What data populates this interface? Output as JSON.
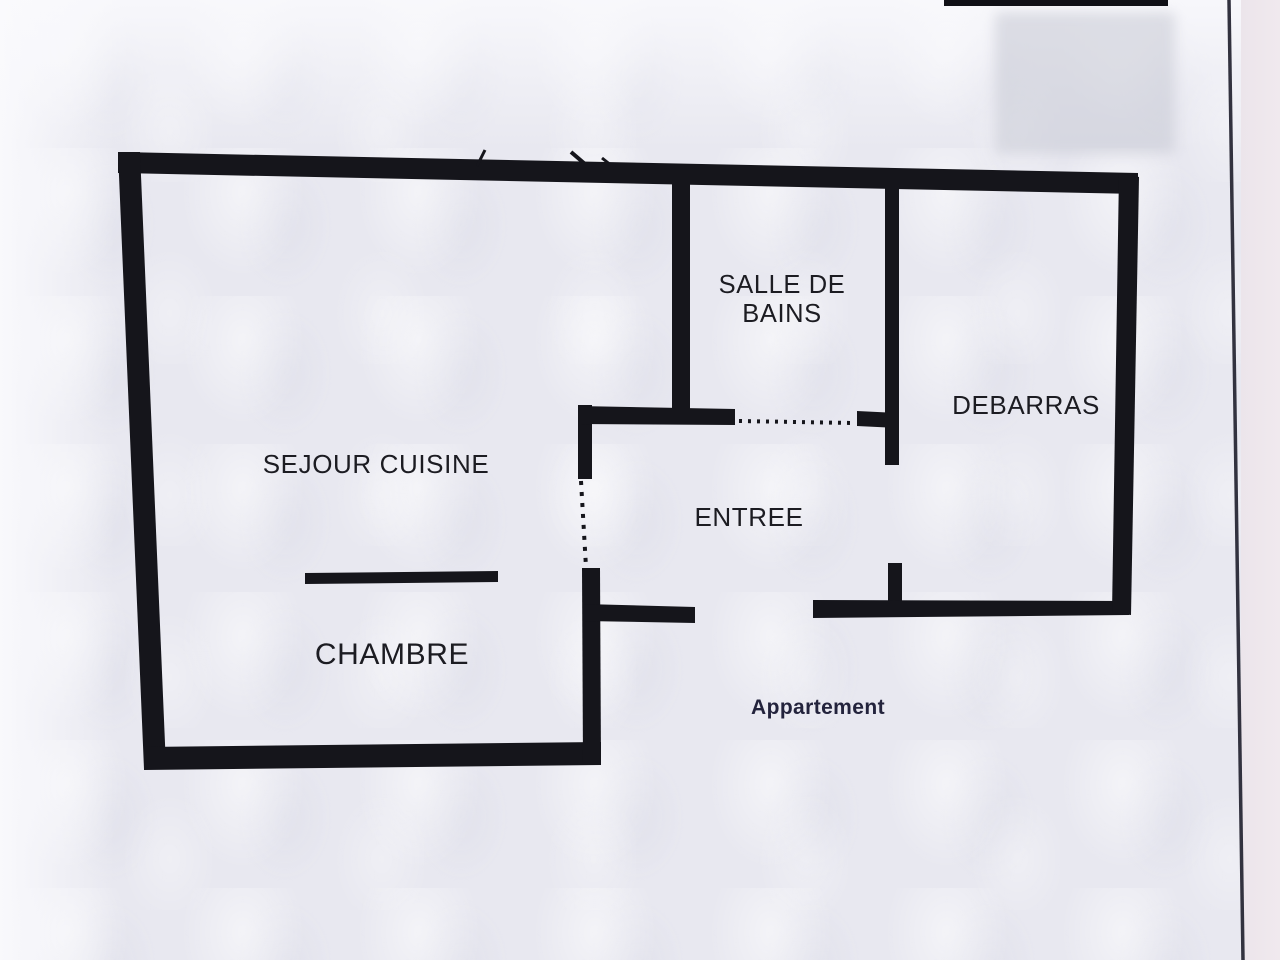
{
  "document": {
    "type": "scanned apartment floor plan",
    "caption": "Appartement"
  },
  "rooms": [
    {
      "name": "SEJOUR CUISINE"
    },
    {
      "name": "CHAMBRE"
    },
    {
      "name": "SALLE DE BAINS"
    },
    {
      "name": "ENTREE"
    },
    {
      "name": "DEBARRAS"
    }
  ],
  "labels": {
    "sejour_cuisine": "SEJOUR CUISINE",
    "chambre": "CHAMBRE",
    "salle_de_bains_line1": "SALLE DE",
    "salle_de_bains_line2": "BAINS",
    "entree": "ENTREE",
    "debarras": "DEBARRAS",
    "appartement": "Appartement"
  },
  "colors": {
    "wall": "#15151b",
    "text": "#1c1c22",
    "caption_text": "#23233c",
    "paper": "#e8e8f0"
  }
}
